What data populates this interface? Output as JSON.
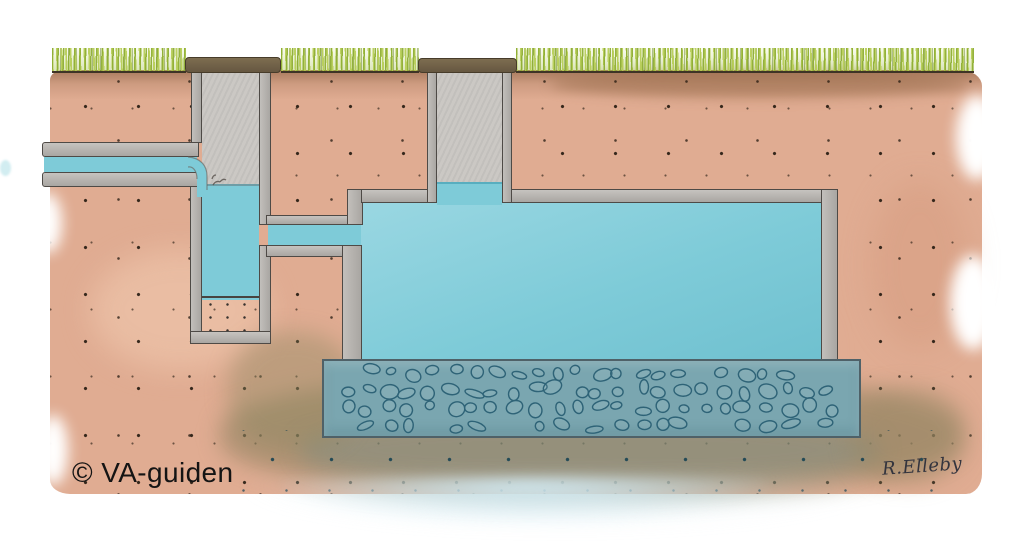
{
  "labels": {
    "copyright": "© VA-guiden",
    "signature": "R.Elleby"
  },
  "colors": {
    "soil": "#e0ac92",
    "soil-dark": "#b08a6a",
    "grass": "#b5cc52",
    "grass-dark": "#8fae35",
    "water": "#7ecbd8",
    "water-light": "#9ad7e2",
    "wall": "#a9a6a2",
    "wall-line": "#4e4a46",
    "shaft": "#cbc8c4",
    "lid": "#665741",
    "sludge": "#6b6865",
    "gravel": "#7aa6b0",
    "stone-line": "#2e6377",
    "wet-soil": "#a99c7f",
    "wash": "#cfe9f2"
  }
}
